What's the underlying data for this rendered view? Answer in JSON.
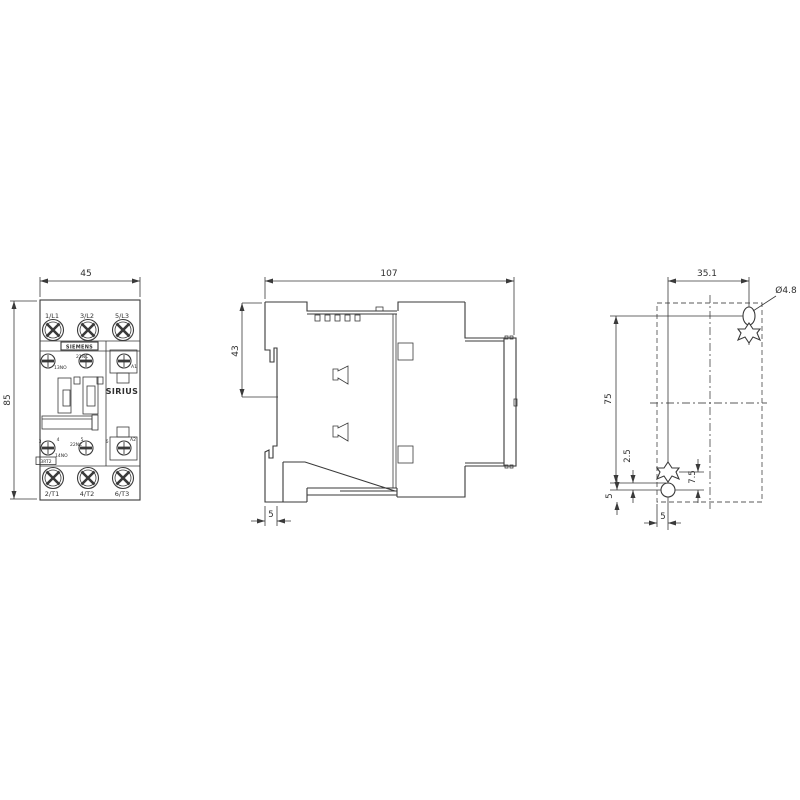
{
  "front_view": {
    "dim_width": "45",
    "dim_height": "85",
    "terminals_top": [
      "1/L1",
      "3/L2",
      "5/L3"
    ],
    "terminals_bottom": [
      "2/T1",
      "4/T2",
      "6/T3"
    ],
    "brand": "SIEMENS",
    "series": "SIRIUS",
    "model": "3RT2",
    "aux": {
      "top_left": "13NO",
      "top_mid": "21NC",
      "coil_top": "A1",
      "bottom_left": "14NO",
      "bottom_mid": "22NC",
      "coil_bottom": "A2"
    },
    "positions": [
      "3",
      "4",
      "5",
      "6"
    ]
  },
  "side_view": {
    "dim_width": "107",
    "dim_height": "43",
    "dim_foot": "5"
  },
  "mounting_view": {
    "dim_h": "35.1",
    "dim_v": "75",
    "hole_label": "Ø4.8",
    "dim_a": "2.5",
    "dim_b": "7.5",
    "dim_c": "5",
    "dim_d": "5"
  }
}
